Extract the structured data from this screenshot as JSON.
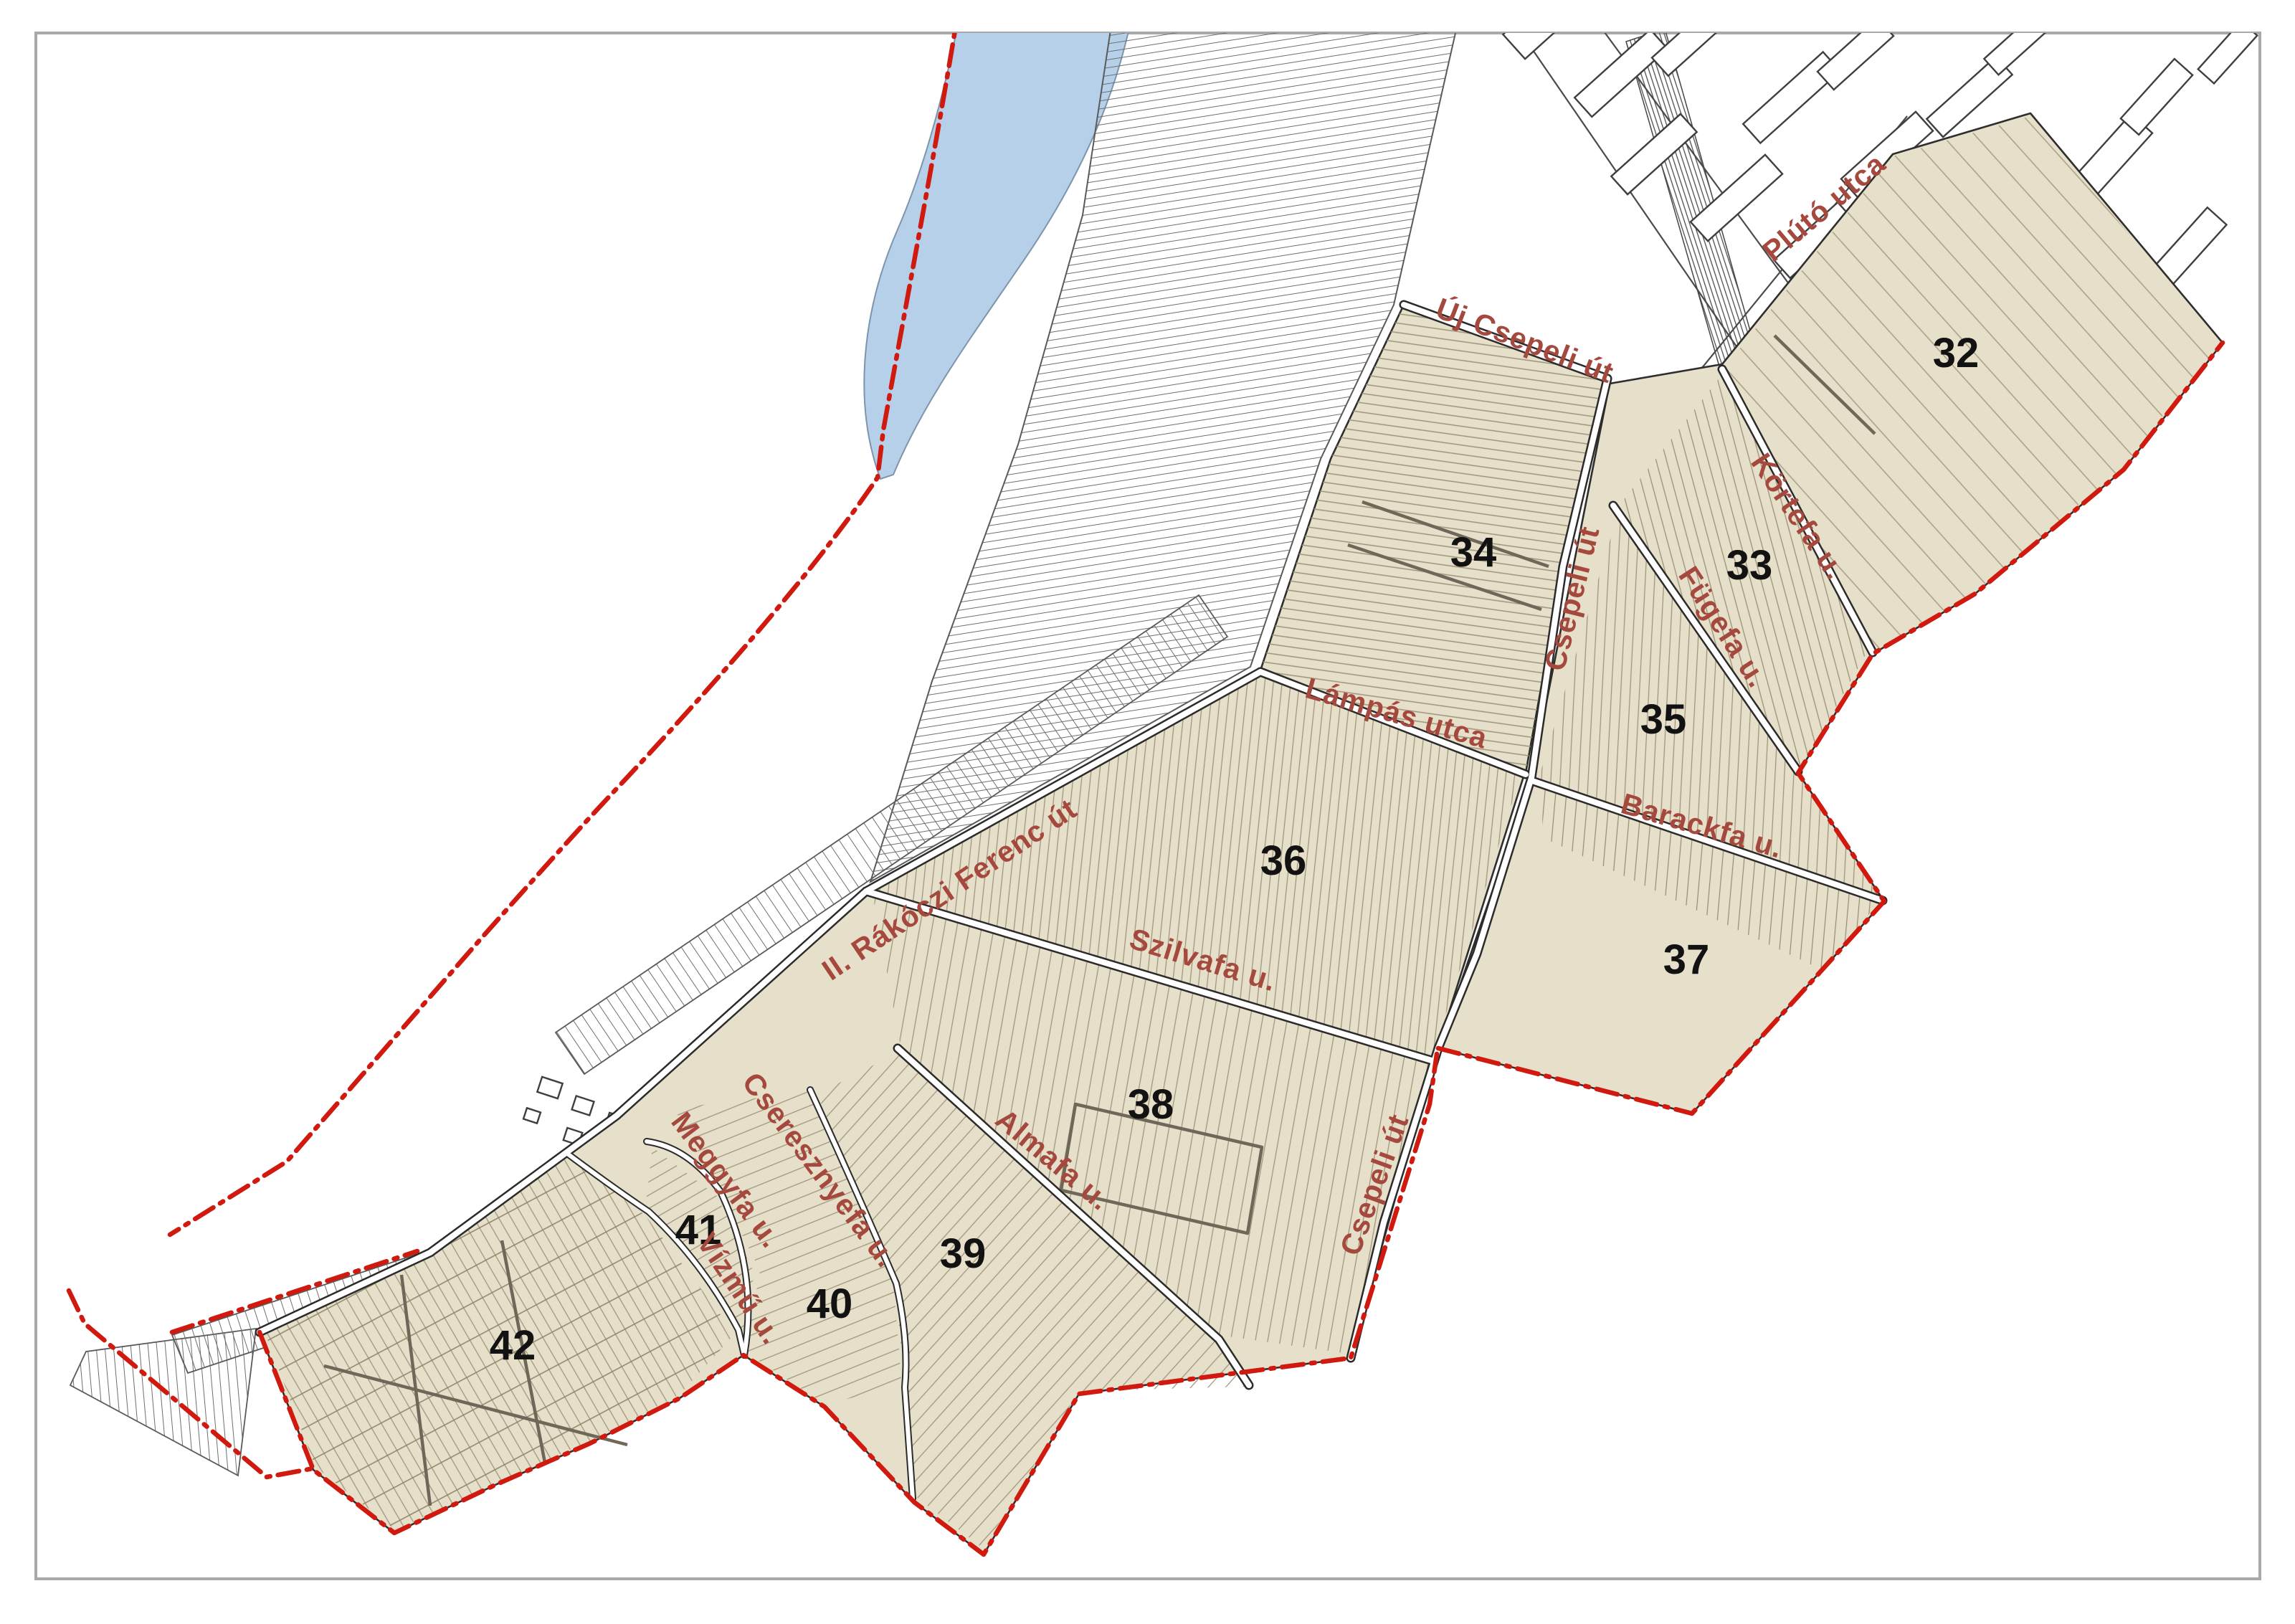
{
  "page": {
    "type": "district zoning map page"
  },
  "colors": {
    "zone_fill": "#e6dfc9",
    "river": "#b7d0e9",
    "boundary_red": "#d0190f",
    "street_label": "#a5493e",
    "zone_number": "#121212",
    "parcel_line": "#9e947a",
    "outline": "#2e2e2e",
    "frame": "#a9a9a9"
  },
  "zones": {
    "z32": {
      "label": "32"
    },
    "z33": {
      "label": "33"
    },
    "z34": {
      "label": "34"
    },
    "z35": {
      "label": "35"
    },
    "z36": {
      "label": "36"
    },
    "z37": {
      "label": "37"
    },
    "z38": {
      "label": "38"
    },
    "z39": {
      "label": "39"
    },
    "z40": {
      "label": "40"
    },
    "z41": {
      "label": "41"
    },
    "z42": {
      "label": "42"
    }
  },
  "streets": {
    "pluto": {
      "name": "Plútó utca"
    },
    "uj_csepeli": {
      "name": "Új Csepeli út"
    },
    "csepeli_upper": {
      "name": "Csepeli út"
    },
    "csepeli_lower": {
      "name": "Csepeli út"
    },
    "kortefa": {
      "name": "Körtefa u."
    },
    "fugefa": {
      "name": "Fügefa u."
    },
    "lampas": {
      "name": "Lámpás utca"
    },
    "barackfa": {
      "name": "Barackfa u."
    },
    "szilvafa": {
      "name": "Szilvafa u."
    },
    "rakoczi": {
      "name": "II. Rákóczi Ferenc út"
    },
    "almafa": {
      "name": "Almafa u."
    },
    "meggyfa": {
      "name": "Meggyfa u."
    },
    "cseresznyefa": {
      "name": "Cseresznyefa u."
    },
    "vizmu": {
      "name": "Vízmű u."
    }
  }
}
